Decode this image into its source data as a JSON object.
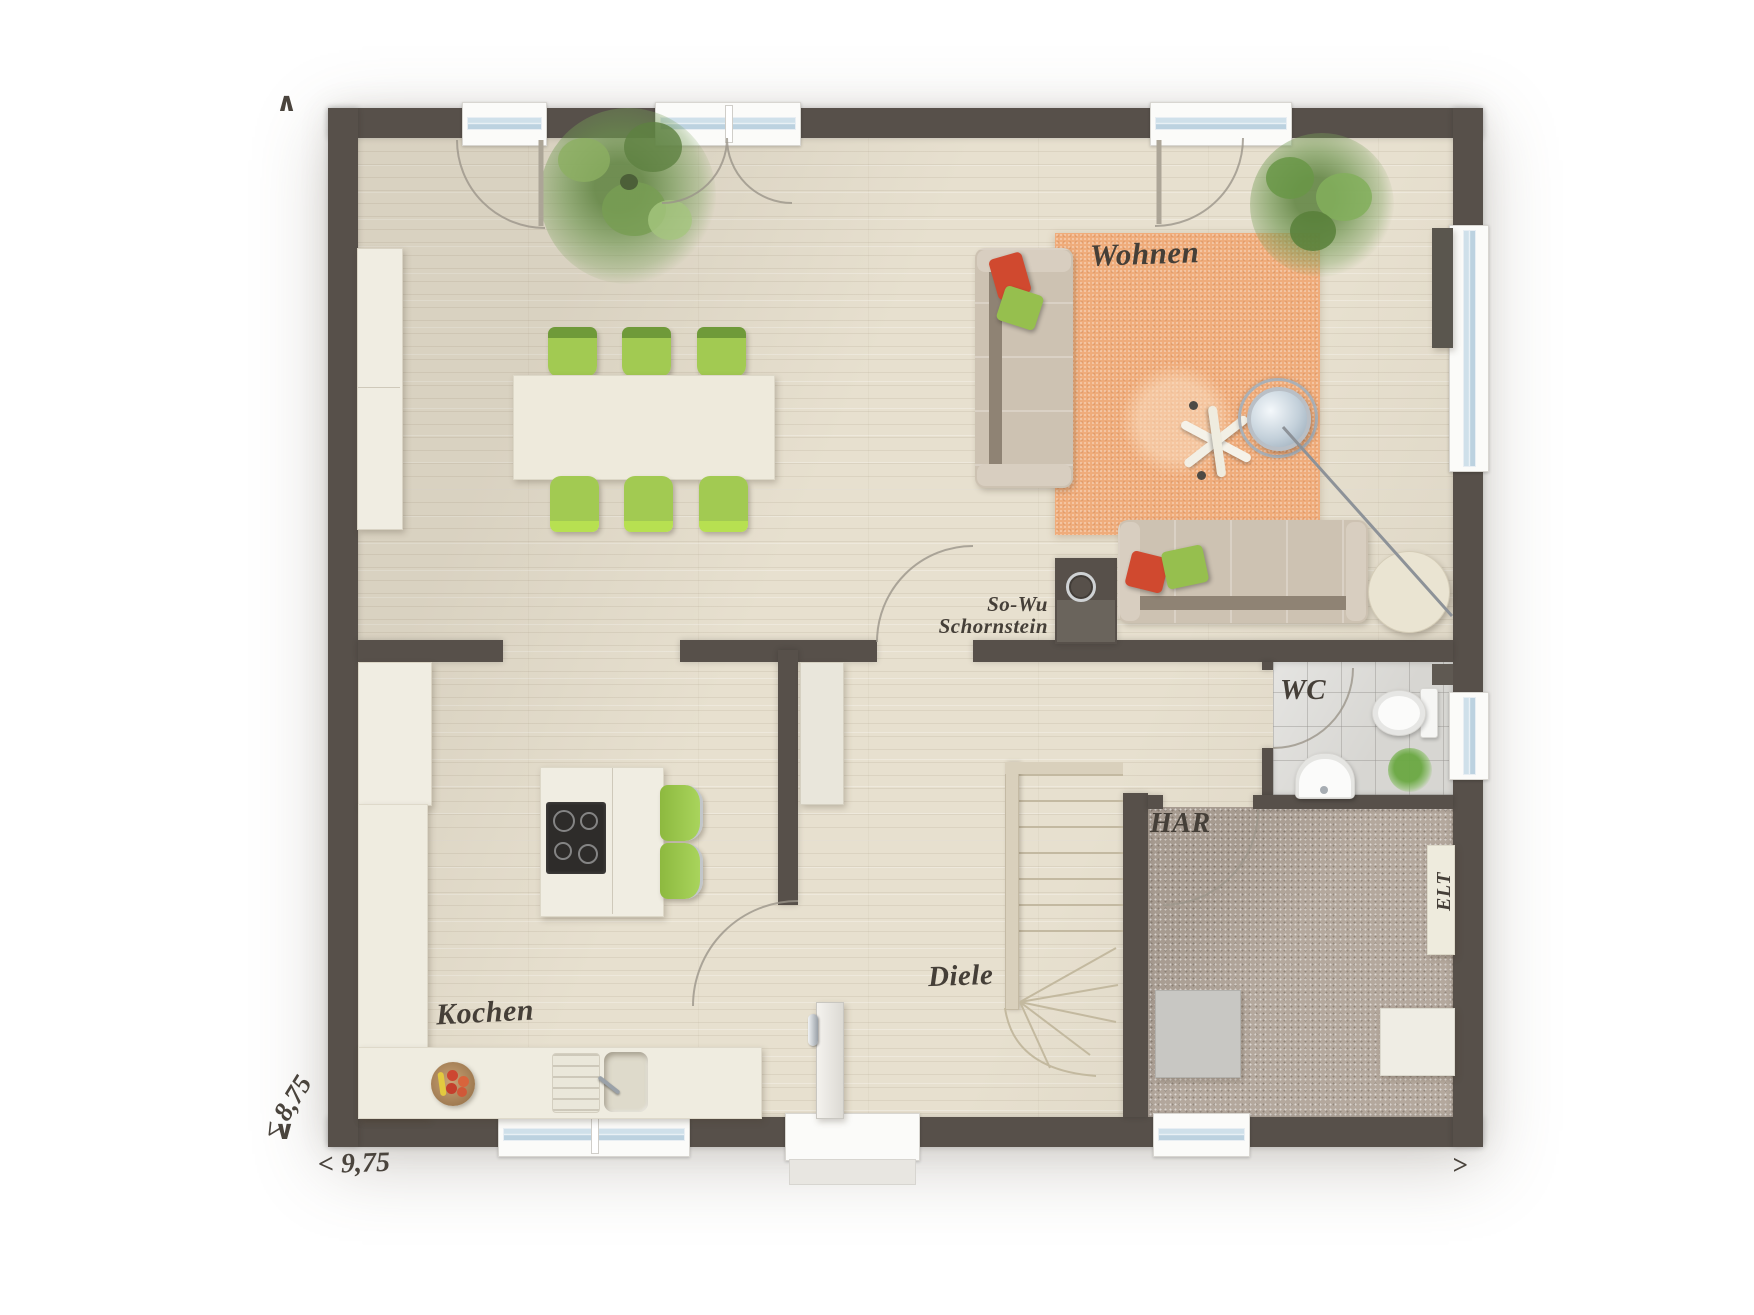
{
  "plan": {
    "rooms": {
      "living": {
        "label": "Wohnen"
      },
      "kitchen": {
        "label": "Kochen"
      },
      "hall": {
        "label": "Diele"
      },
      "wc": {
        "label": "WC"
      },
      "utility": {
        "label": "HAR"
      },
      "elt": {
        "label": "ELT"
      },
      "chimney": {
        "line1": "So-Wu",
        "line2": "Schornstein"
      }
    },
    "dimensions": {
      "width_label": "< 9,75",
      "height_label": "< 8,75",
      "arrow_top": "∧",
      "arrow_bottom": "∨",
      "arrow_right": ">"
    },
    "colors": {
      "wall": "#57504a",
      "wood_floor": "#e7e0cf",
      "rug": "#efac7b",
      "carpet_har": "#b4a89d",
      "tile_wc": "#d7d6d2",
      "counter": "#efece0",
      "chair_green": "#a2ca52",
      "pillow_red": "#d0492f",
      "pillow_green": "#96bf4e",
      "sofa": "#cdc2b2"
    }
  }
}
